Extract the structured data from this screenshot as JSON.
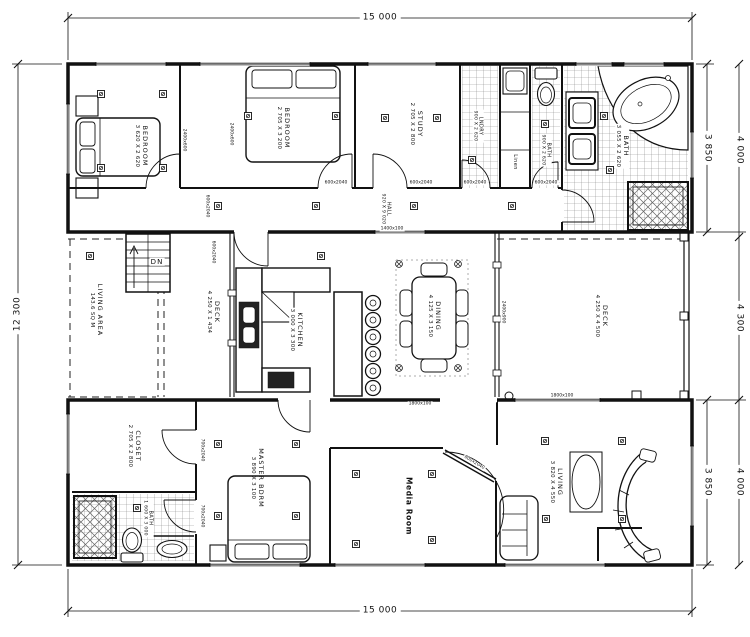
{
  "drawing_title": "House Floor Plan",
  "rooms": {
    "bedroom1": {
      "name": "BEDROOM",
      "size": "3 620 X 2 620"
    },
    "bedroom2": {
      "name": "BEDROOM",
      "size": "2 705 X 3 200"
    },
    "study": {
      "name": "STUDY",
      "size": "2 705 X 2 800"
    },
    "laundry": {
      "name": "LNDRY",
      "size": "900 X 2 620"
    },
    "linen": {
      "name": "Linen",
      "size": ""
    },
    "wc": {
      "name": "BATH",
      "size": "900 X 2 620"
    },
    "bathroom": {
      "name": "BATH",
      "size": "3 055 X 2 620"
    },
    "hall": {
      "name": "HALL",
      "size": "920 X 9 020"
    },
    "living_area": {
      "name": "LIVING AREA",
      "size": "143.6 SQ M"
    },
    "deck_small": {
      "name": "DECK",
      "size": "4 250 X 1 434"
    },
    "kitchen": {
      "name": "KITCHEN",
      "size": "3 000 X 3 300"
    },
    "dining": {
      "name": "DINING",
      "size": "4 125 X 3 150"
    },
    "deck_large": {
      "name": "DECK",
      "size": "4 250 X 4 500"
    },
    "closet": {
      "name": "CLOSET",
      "size": "2 705 X 2 800"
    },
    "ensuite": {
      "name": "BATH",
      "size": "1 600 X 3 000"
    },
    "master": {
      "name": "MASTER BDRM",
      "size": "3 890 X 3 100"
    },
    "media": {
      "name": "Media Room",
      "size": ""
    },
    "living": {
      "name": "LIVING",
      "size": "3 820 X 4 550"
    }
  },
  "stairs": {
    "label": "DN"
  },
  "dims": {
    "top": "15 000",
    "bottom": "15 000",
    "left": "12 300",
    "right_top_inner": "3 850",
    "right_bottom_inner": "3 850",
    "right_top_outer": "4 000",
    "right_mid_outer": "4 300",
    "right_bottom_outer": "4 000"
  },
  "tags": [
    "2400x600",
    "2400x600",
    "600x2040",
    "600x2040",
    "600x2040",
    "600x2040",
    "600x2040",
    "1400x100",
    "600x2040",
    "2400x900",
    "1800x100",
    "1800x100",
    "700x2040",
    "700x2040",
    "800x2040"
  ]
}
